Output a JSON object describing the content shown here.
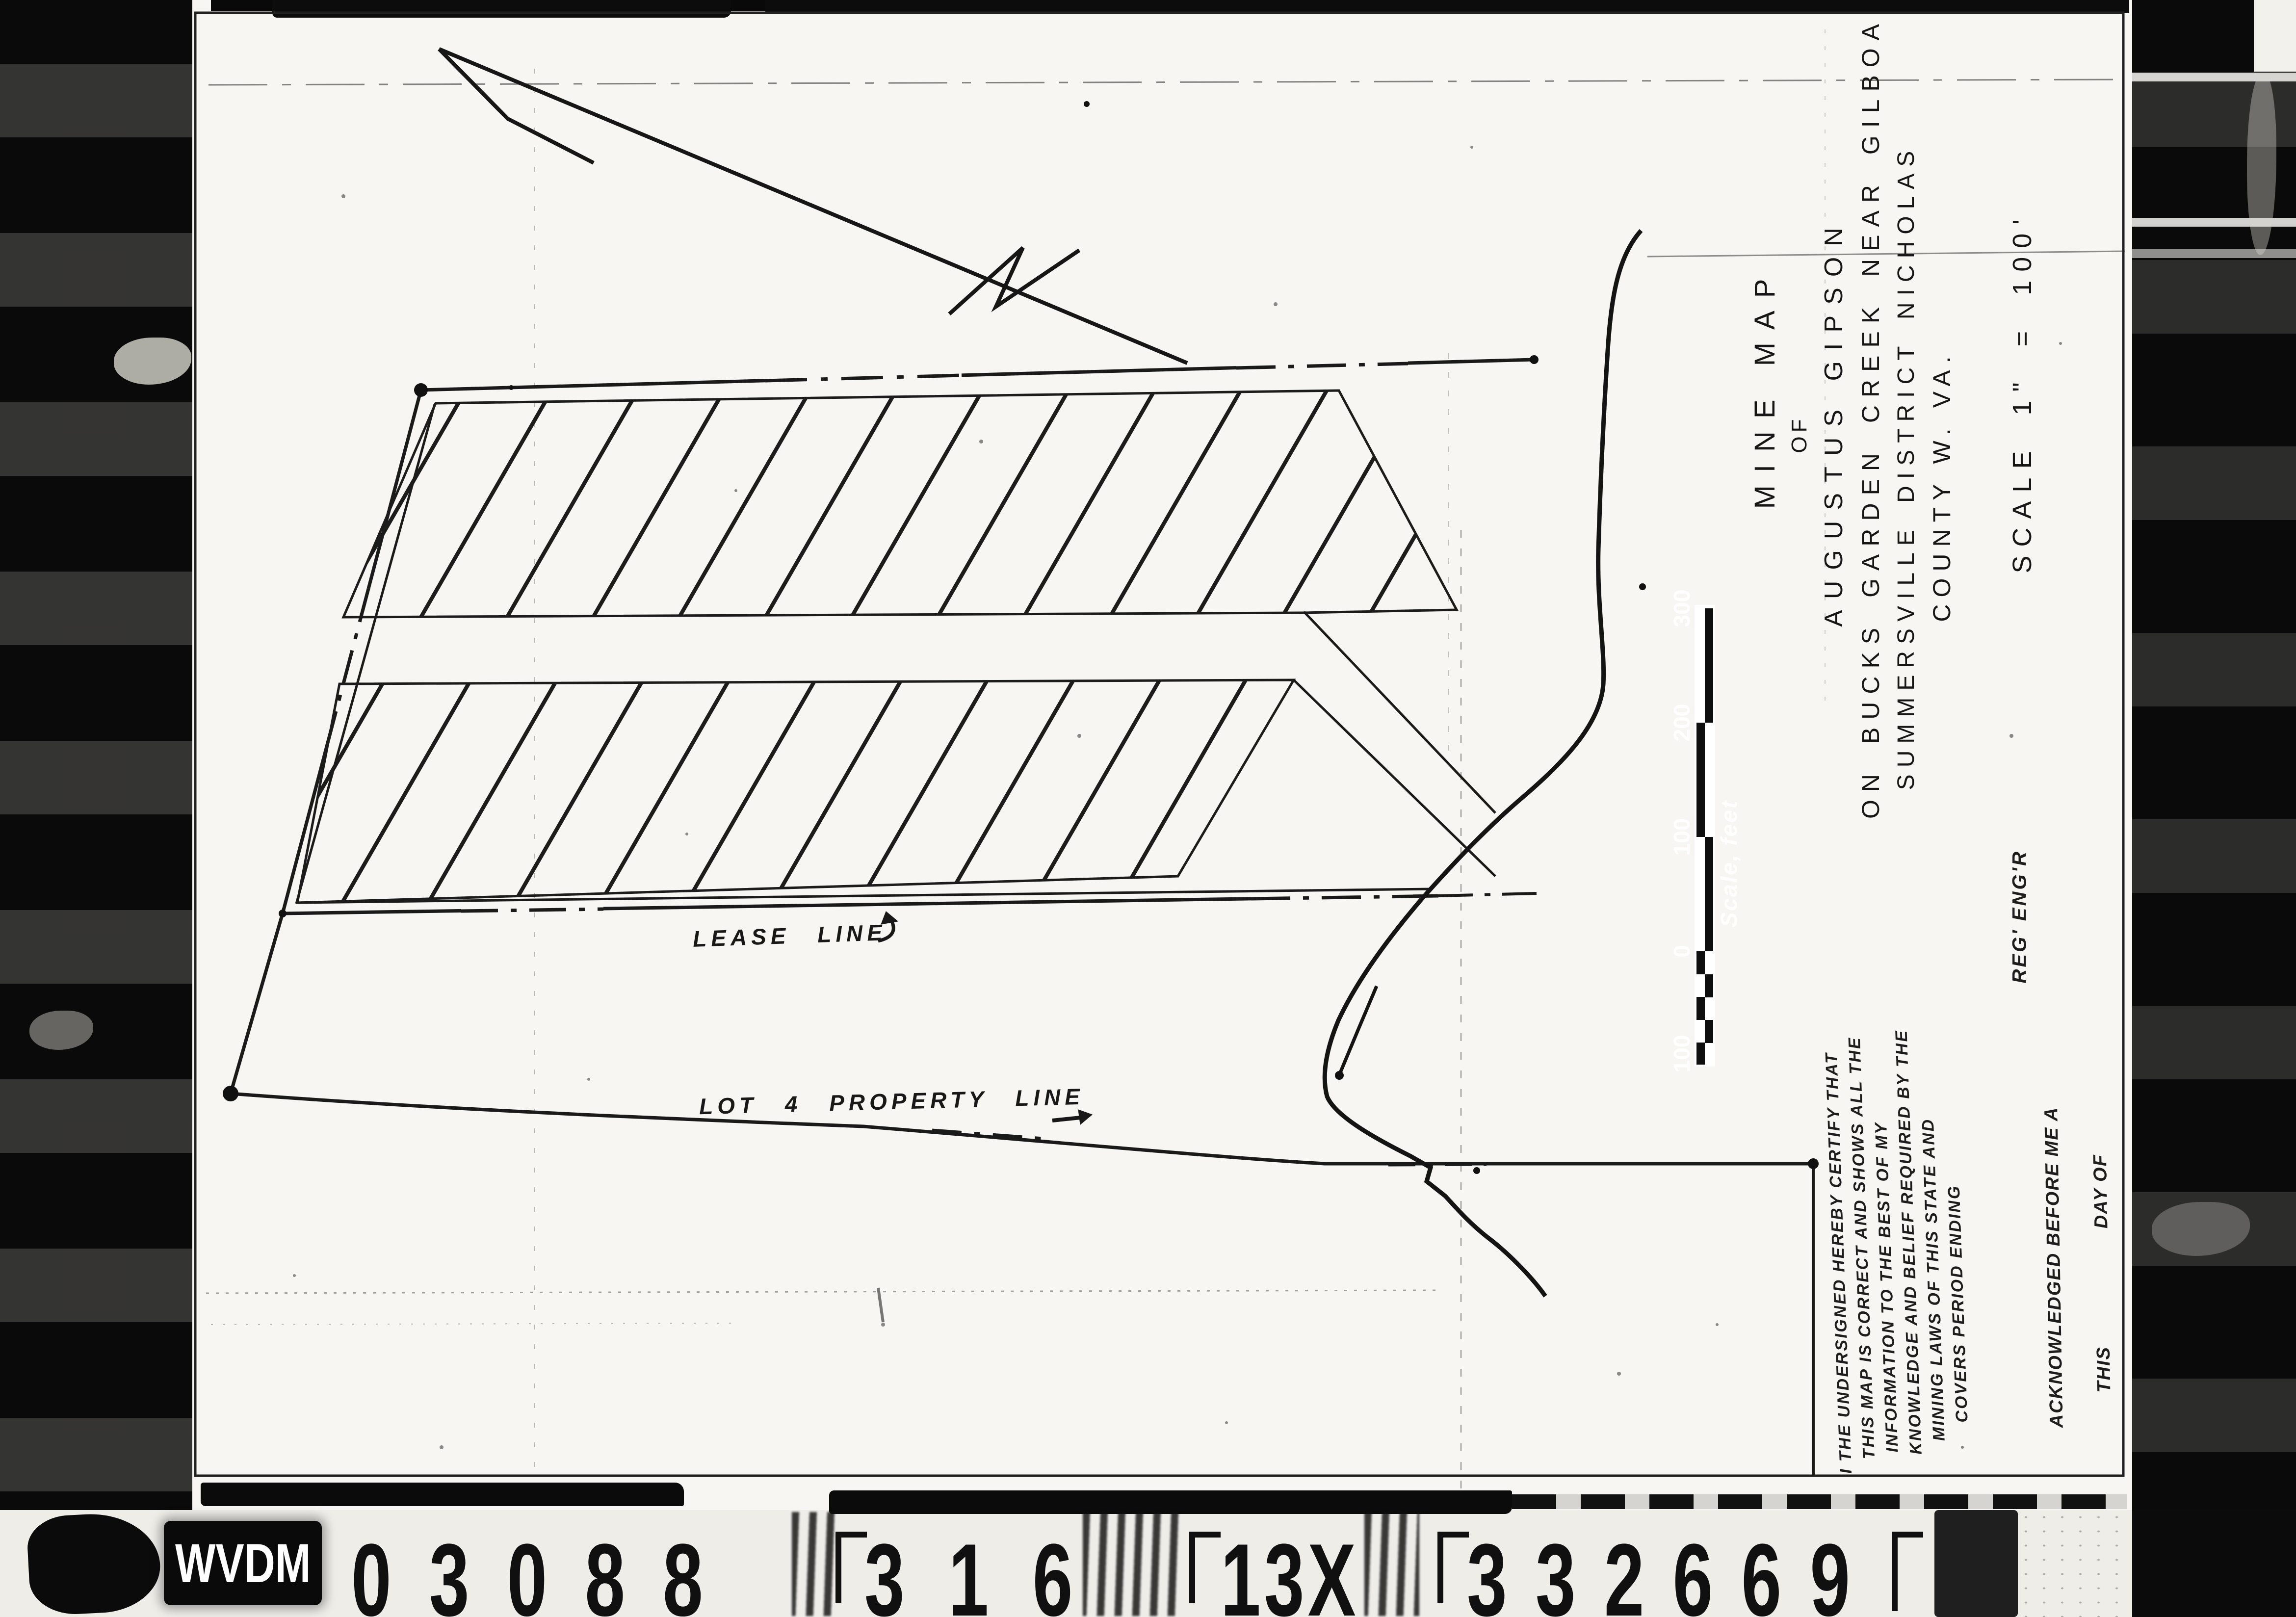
{
  "film_strip": {
    "archive_code": "WVDM",
    "reel_number": "03088",
    "frame_number": "316",
    "magnification": "13X",
    "document_number": "332669"
  },
  "title_block": {
    "line_1": "MINE MAP",
    "line_2": "OF",
    "line_3": "AUGUSTUS GIPSON",
    "line_4": "ON BUCKS GARDEN CREEK NEAR GILBOA",
    "line_5": "SUMMERSVILLE DISTRICT NICHOLAS",
    "line_6": "COUNTY W. VA.",
    "scale_text": "SCALE  1\" = 100'"
  },
  "map_labels": {
    "lease_line": "LEASE LINE",
    "property_line": "LOT 4  PROPERTY LINE"
  },
  "scale_bar": {
    "label": "Scale, feet",
    "ticks": [
      "300",
      "200",
      "100",
      "0",
      "100"
    ]
  },
  "certification": {
    "line_1": "I THE UNDERSIGNED HEREBY CERTIFY THAT",
    "line_2": "THIS MAP IS CORRECT AND SHOWS ALL THE",
    "line_3": "INFORMATION TO THE BEST OF MY",
    "line_4": "KNOWLEDGE AND BELIEF REQUIRED BY THE",
    "line_5": "MINING LAWS OF THIS STATE AND",
    "line_6": "COVERS PERIOD ENDING"
  },
  "signature_block": {
    "reg_engr": "REG' ENG'R",
    "acknowledged": "ACKNOWLEDGED BEFORE ME A",
    "this_label": "THIS",
    "day_of": "DAY OF"
  }
}
